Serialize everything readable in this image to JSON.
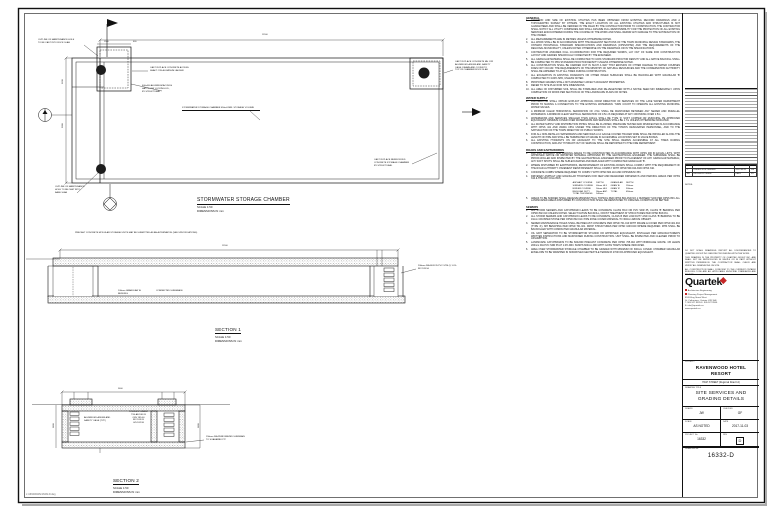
{
  "colors": {
    "line": "#111111",
    "accent_red": "#c62828",
    "paper": "#ffffff"
  },
  "plan": {
    "title": "STORMWATER STORAGE CHAMBER",
    "scale": "SCALE 1:50",
    "dims": "DIMENSIONS IN mm"
  },
  "section1": {
    "title": "SECTION 1",
    "scale": "SCALE 1:50",
    "dims": "DIMENSIONS IN mm"
  },
  "section2": {
    "title": "SECTION 2",
    "scale": "SCALE 1:50",
    "dims": "DIMENSIONS IN mm"
  },
  "callouts": [
    {
      "x": 38,
      "y": 39,
      "w": 48,
      "lines": "OUTLINE OF MAINTENANCE HOLE\nTO BE CAST INTO ROOF SLAB"
    },
    {
      "x": 150,
      "y": 67,
      "w": 54,
      "lines": "CAST IN PLACE CONCRETE ACCESS\nSHAFT C/W ALUMINUM LADDER"
    },
    {
      "x": 142,
      "y": 85,
      "w": 42,
      "lines": "600x600 ALUMINUM ACCESS\nHATCH C/W LOCKING LID,\nBY STRUCTURAL"
    },
    {
      "x": 182,
      "y": 107,
      "w": 78,
      "u": true,
      "lines": "STORMWATER STORAGE CHAMBER 450m3 MIN. STORAGE VOLUME"
    },
    {
      "x": 55,
      "y": 186,
      "w": 40,
      "lines": "OUTLINE OF MAINTENANCE\nHOLE TO BE CAST INTO\nBASE SLAB"
    },
    {
      "x": 455,
      "y": 61,
      "w": 62,
      "lines": "CAST IN PLACE CONCRETE MH C/W\nALUMINUM LADDER AND SAFETY\nCAGE, FRAME AND COVER TO\nTOP OF CHAMBER ROOF SLAB"
    },
    {
      "x": 374,
      "y": 159,
      "w": 48,
      "lines": "CAST IN PLACE REINFORCED\nCONCRETE STORAGE CHAMBER\nBY STRUCTURAL"
    },
    {
      "x": 75,
      "y": 232,
      "w": 172,
      "lines": "PRECAST CONCRETE MODULAR STORAGE UNITS MAY BE SUBMITTED AS AN ALTERNATIVE (SEE SPECIFICATIONS)"
    },
    {
      "x": 418,
      "y": 265,
      "w": 58,
      "lines": "200mm DIA SDR 35 PVC STM @ 1.0%\nINV 183.50"
    },
    {
      "x": 118,
      "y": 290,
      "w": 32,
      "lines": "100mm GRANULAR 'A' BEDDING"
    },
    {
      "x": 156,
      "y": 290,
      "w": 30,
      "lines": "COMPACTED SUBGRADE"
    },
    {
      "x": 84,
      "y": 417,
      "w": 38,
      "lines": "ALUMINUM LADDER AND\nSAFETY CAGE (TYP.)"
    },
    {
      "x": 125,
      "y": 411,
      "w": 27,
      "center": true,
      "lines": "FINISHED GRADE\nT/SLAB 186.20\nOBV 185.00\nINV 183.20\nU/S 182.90"
    },
    {
      "x": 206,
      "y": 436,
      "w": 46,
      "lines": "150mm DIA PERFORATED SUBDRAIN\nTO SOAKAWAY PIT"
    }
  ],
  "dim_labels": [
    {
      "x": 262,
      "y": 34,
      "t": "11500"
    },
    {
      "x": 104,
      "y": 41,
      "t": "1500"
    },
    {
      "x": 133,
      "y": 41,
      "t": "600"
    },
    {
      "x": 62,
      "y": 128,
      "t": "5000",
      "rot": -90
    },
    {
      "x": 62,
      "y": 84,
      "t": "1200",
      "rot": -90
    },
    {
      "x": 222,
      "y": 245,
      "t": "11500"
    },
    {
      "x": 118,
      "y": 388,
      "t": "5600"
    },
    {
      "x": 198,
      "y": 428,
      "t": "2800",
      "rot": -90
    },
    {
      "x": 53,
      "y": 428,
      "t": "2800",
      "rot": -90
    }
  ],
  "notes": {
    "sections": [
      {
        "heading": "GENERAL",
        "items": [
          "LOCATION AND SIZE OF EXISTING UTILITIES HAS BEEN OBTAINED FROM EXISTING RECORD DRAWINGS AND A TOPOGRAPHIC SURVEY BY OTHERS. THE EXACT LOCATION OF ALL EXISTING UTILITIES AND STRUCTURES IS NOT GUARANTEED AND SHALL BE VERIFIED IN THE FIELD BY THE CONTRACTOR PRIOR TO CONSTRUCTION. THE CONTRACTOR SHALL NOTIFY ALL UTILITY COMPANIES AND SHALL ASSUME FULL RESPONSIBILITY FOR THE PROTECTION OF ALL EXISTING SERVICES ENCOUNTERED DURING THE COURSE OF THE WORK AND SHALL REPAIR ANY DAMAGE TO THE SATISFACTION OF THE OWNER.",
          "ALL MEASUREMENTS ARE IN METRES UNLESS OTHERWISE NOTED.",
          "ALL WORK SHALL BE IN ACCORDANCE WITH THE RELEVANT SECTIONS OF THE TOWN MUNICIPAL DESIGN STANDARDS, THE ONTARIO PROVINCIAL STANDARD SPECIFICATIONS AND DRAWINGS (OPSS/OPSD) AND THE REQUIREMENTS OF THE REGIONAL MUNICIPALITY, UNLESS NOTED OTHERWISE ON THE DRAWINGS OR IN THE SPECIFICATIONS.",
          "CONTRACTOR ASSUMES FULL CO-ORDINATION FOR THE REQUIRED WORKS, LAY OUT OF SAME FOR CONSTRUCTION LAYOUT AND GRADES SPECIFICALLY DIRECTED BY THE ENGINEER.",
          "ALL GRANULAR MATERIAL SHALL BE COMPACTED TO 100% STANDARD PROCTOR DENSITY AND ALL NATIVE BACKFILL SHALL BE COMPACTED TO 95% STANDARD PROCTOR DENSITY UNLESS OTHERWISE NOTED.",
          "ALL CONSTRUCTION SHALL BE CARRIED OUT IN SUCH A WAY THAT EROSION OF OTHER DAMAGE TO WATER COURSES DOES NOT OCCUR. THE REQUIREMENTS OF THE MINISTRY OF NATURAL RESOURCES AND THE CONSERVATION AUTHORITY SHALL BE ADHERED TO AT ALL TIMES DURING CONSTRUCTION.",
          "ALL EXCAVATION IN EXISTING ROADWAYS OR OTHER PAVED SURFACES SHALL BE BACKFILLED WITH GRANULAR 'B' COMPACTED TO 100% SPD, UNLESS NOTED.",
          "PROPOSED GRADES SHALL NOT ADVERSELY AFFECT ADJACENT PROPERTIES.",
          "REFER TO SITE PLAN FOR SITE DIMENSIONS.",
          "ALL AREA OF DISTURBED SOIL SHALL BE STABILIZED AND RE-VEGETATED WITH A NATIVE SEED MIX IMMEDIATELY UPON COMPLETION OF WORK PER SECTION 02 OF THE LANDSCAPE PLANS OR NOTES."
        ]
      },
      {
        "heading": "WATER SUPPLY",
        "items": [
          "CONTRACTOR SHALL OBTAIN EXPLICIT APPROVAL FROM DIRECTOR OF SERVICES OF THE LAKE WATER DEPARTMENT PRIOR TO MAKING A CONNECTION TO THE EXISTING WATERMAIN. TURN COUNT TO OPERATE ALL EXISTING MUNICIPAL WATER VALVES.",
          "A MINIMUM CLEAR HORIZONTAL SEPARATION OF 2.5m SHALL BE MAINTAINED BETWEEN ANY SEWER AND PARALLEL WATERMAIN. A MINIMUM CLEAR VERTICAL SEPARATION OF 0.5m IS REQUIRED AT ANY CROSSING OVER 2.5m.",
          "WATERMAINS AND SERVICES SMALLER THAN 100mm SHALL BE TYPE 'K' SOFT COPPER OR MUNICIPAL PE APPROVED EQUIVALENT. MINIMUM COVER OVER WATERMAINS AND SERVICES SHALL BE 1.7m UNLESS OTHERWISE INDICATED.",
          "ALL WATER SUPPLY AND DISTRIBUTION PIPING SHALL BE FLUSHED, PRESSURE TESTED AND DISINFECTED IN ACCORDANCE WITH OPSS 441 AND AWWA C651 UNDER THE DIRECTION OF THE TOWN'S DESIGNATED PERSONNEL, AND TO THE SATISFACTION OF THE TOWN DIRECTOR OF PUBLIC WORKS.",
          "FOR ALL NON-METALLIC WATERMAINS AND SERVICES A 12 GAUGE COATED TRACER WIRE SHALL BE INSTALLED ALONG THE LENGTH OF PIPE AND SHALL BE TERMINATED AT GRADE IN ACCESSIBLE LOCATIONS SET IN VALVE BOXES.",
          "ALL EXISTING HYDRANTS ON OR ADJACENT TO THE SITE SHALL REMAIN ACCESSIBLE AT ALL TIMES DURING CONSTRUCTION, AND ANY HYDRANT OUT OF SERVICE SHALL BE REPORTED TO THE FIRE DEPARTMENT."
        ]
      },
      {
        "heading": "ROADS AND EARTHWORKS",
        "items": [
          "FILL FOR ROADWAY AND PARKING AREAS TO BE CONSTRUCTED IN ACCORDANCE WITH OPSS 206 IN EQUAL LIFTS, WITH APPROVED NATIVE OR IMPORTED MATERIAL APPROVED BY THE GEOTECHNICAL ENGINEER. THE SUBGRADE SHALL BE PROOF-ROLLED AND INSPECTED BY THE GEOTECHNICAL ENGINEER PRIOR TO PLACEMENT OF ANY GRANULAR MATERIAL; ANY SOFT SPOTS SHALL BE SUB-EXCAVATED AND REPLACED WITH COMPACTED GRANULAR 'B'.",
          "WHERE DISTURBED BY EARTHWORKS, REINSTATEMENT OF EXISTING ROADS SHALL COMPLY WITH THE REQUIREMENT OF THE ROAD AUTHORITY. PAVEMENT REINSTATEMENT SHALL COMPLY WITH OPSD 509.010 AND OPSS 310.",
          "CONCRETE CURBS WHERE REQUIRED TO COMPLY WITH OPSD 600.110 AND OPSS/MUNI 353.",
          "DRIVEWAY ASPHALT AND GRANULAR THICKNESS FOR NEW AND REGRADED DRIVEWAYS AND PARKING AREAS PER OPSS 310 & THE MIX FOLLOWS:"
        ],
        "table": [
          [
            "ASPHALT COURSE",
            "DEPTH",
            "GRANULAR",
            "DEPTH"
          ],
          [
            "SURFACE COURSE",
            "40mm HL3",
            "GRAN 'A'",
            "150mm"
          ],
          [
            "BINDER COURSE",
            "50mm HL8",
            "GRAN 'B'",
            "300mm"
          ],
          [
            "REGULAR DUTY",
            "90mm ASP.",
            "TOTAL",
            "450mm"
          ],
          [
            "TOTAL THICKNESS",
            "540mm",
            "",
            ""
          ]
        ],
        "items_after": [
          "AREAS TO BE SODDED SHALL RECEIVE MINIMUM 75mm TOPSOIL PER OPSS 802 AND NO.1 NURSERY SOD PER OPSS 803. ALL LANDSCAPED AREAS DISTURBED BY CONSTRUCTION SHALL BE REINSTATED TO ORIGINAL CONDITION OR BETTER."
        ]
      },
      {
        "heading": "SEWERS",
        "items": [
          "ALL STORM SEWERS AND CATCHBASIN LEADS TO BE CONCRETE CLASS 65-D OR PVC SDR 35, CLASS 'B' BEDDING PER OPSD 802.010 UNLESS NOTED. SELECT NATIVE BACKFILL, FROST TREATMENT AT STRUCTURES PER OPSD 803.031.",
          "ALL STORM SEWERS AND CATCHBASIN LEADS TO BE CONCRETE, CLASS B PER LOW-DUTY AND CLASS 'B' BEDDING TO BE 19mm CRUSHED STONE PER OPSD 802.010. PIPE ZONE COVER MATERIAL TO 300mm ABOVE OBVERT.",
          "SEWER MAINTENANCE HOLES SHALL BE PRECAST CONCRETE PER OPSD 701.010 WITH FRAME & COVER PER OPSD 401.010 (TYPE 'A'). MH BENCHING PER OPSD 701.021. DROP STRUCTURES PER OPSD 1003.020 WHERE REQUIRED. MHS SHALL BE BACKFILLED WITH COMPACTED GRANULAR MATERIAL.",
          "OIL GRIT SEPARATOR TO BE STORMCEPTOR STC2000 OR APPROVED EQUIVALENT, INSTALLED PER MANUFACTURER'S WRITTEN INSTRUCTIONS AND MAINTAINED DURING CONSTRUCTION. UNIT SHALL BE INSPECTED AND CLEANED PRIOR TO ASSUMPTION.",
          "LANDSCAPE CATCHBASINS TO BE 600x600 PRECAST CONCRETE PER OPSD 705.010 WITH BIRDCAGE GRATE. CB LEADS 200mm DIA PVC SDR 35 AT 1.0% MIN. SUMPS 600mm MIN WITH GOSS TRAPS WHERE INDICATED.",
          "AREA OVER STORMWATER STORAGE CHAMBER TO BE GRADED WITH MINIMUM OF 300mm COVER. CHAMBER GRANULAR ENVELOPE TO BE WRAPPED IN NONWOVEN GEOTEXTILE TERRAFIX 270R OR APPROVED EQUIVALENT."
        ]
      }
    ]
  },
  "title_block": {
    "rev_table": [
      [
        "D",
        "REISSUED FOR CONSTRUCTION",
        "2017-11-03",
        "JW"
      ],
      [
        "C",
        "ISSUED FOR TENDER",
        "2017-09-22",
        "JW"
      ],
      [
        "No.",
        "REVISION / ISSUE",
        "DATE",
        "BY"
      ]
    ],
    "notes_label": "NOTES:",
    "legal": [
      "DO NOT SCALE DRAWINGS. REPORT ALL DISCREPANCIES TO QUARTEK GROUP INC. BEFORE PROCEEDING WITH THE WORK.",
      "THIS DRAWING IS THE PROPERTY OF QUARTEK GROUP INC. AND SHALL NOT BE REPRODUCED IN WHOLE OR IN PART WITHOUT WRITTEN PERMISSION. THE CONTRACTOR SHALL CHECK AND VERIFY ALL DIMENSIONS ON SITE.",
      "ALL CONSTRUCTION SHALL CONFORM TO THE CURRENT ONTARIO BUILDING CODE AND ALL APPLICABLE MUNICIPAL STANDARDS AND BYLAWS."
    ],
    "logo_text": "Quartek",
    "contacts": [
      {
        "b": true,
        "t": "Architecture   Engineering"
      },
      {
        "b": true,
        "t": "Planning   Project Management"
      },
      {
        "b": false,
        "t": "89-B King Street West"
      },
      {
        "b": false,
        "t": "St. Catharines, Ontario L2R 3H6"
      },
      {
        "b": false,
        "t": "T: 905.527.9555   F: 905.527.9556"
      },
      {
        "b": false,
        "t": "E: info@quartek.ca"
      },
      {
        "b": false,
        "t": "www.quartek.ca"
      }
    ],
    "project_label": "PROJECT",
    "project_name": "RAVENWOOD HOTEL\nRESORT",
    "project_sub": "HIGH STREET (Regional Road 12)",
    "title_label": "DRAWING TITLE",
    "drawing_title": "SITE SERVICES AND\nGRADING DETAILS",
    "fields": [
      {
        "label": "DRAWN",
        "value": "JW"
      },
      {
        "label": "CHECKED",
        "value": "GF"
      },
      {
        "label": "SCALE",
        "value": "AS NOTED"
      },
      {
        "label": "DATE",
        "value": "2017-11-03"
      },
      {
        "label": "PROJECT No.",
        "value": "16332"
      },
      {
        "label": "REV",
        "value": "D",
        "boxed": true
      }
    ],
    "drawing_no_label": "DRAWING No.",
    "drawing_no": "16332-D"
  },
  "footer_path": "L:\\16332\\DWG\\16332-D.dwg"
}
